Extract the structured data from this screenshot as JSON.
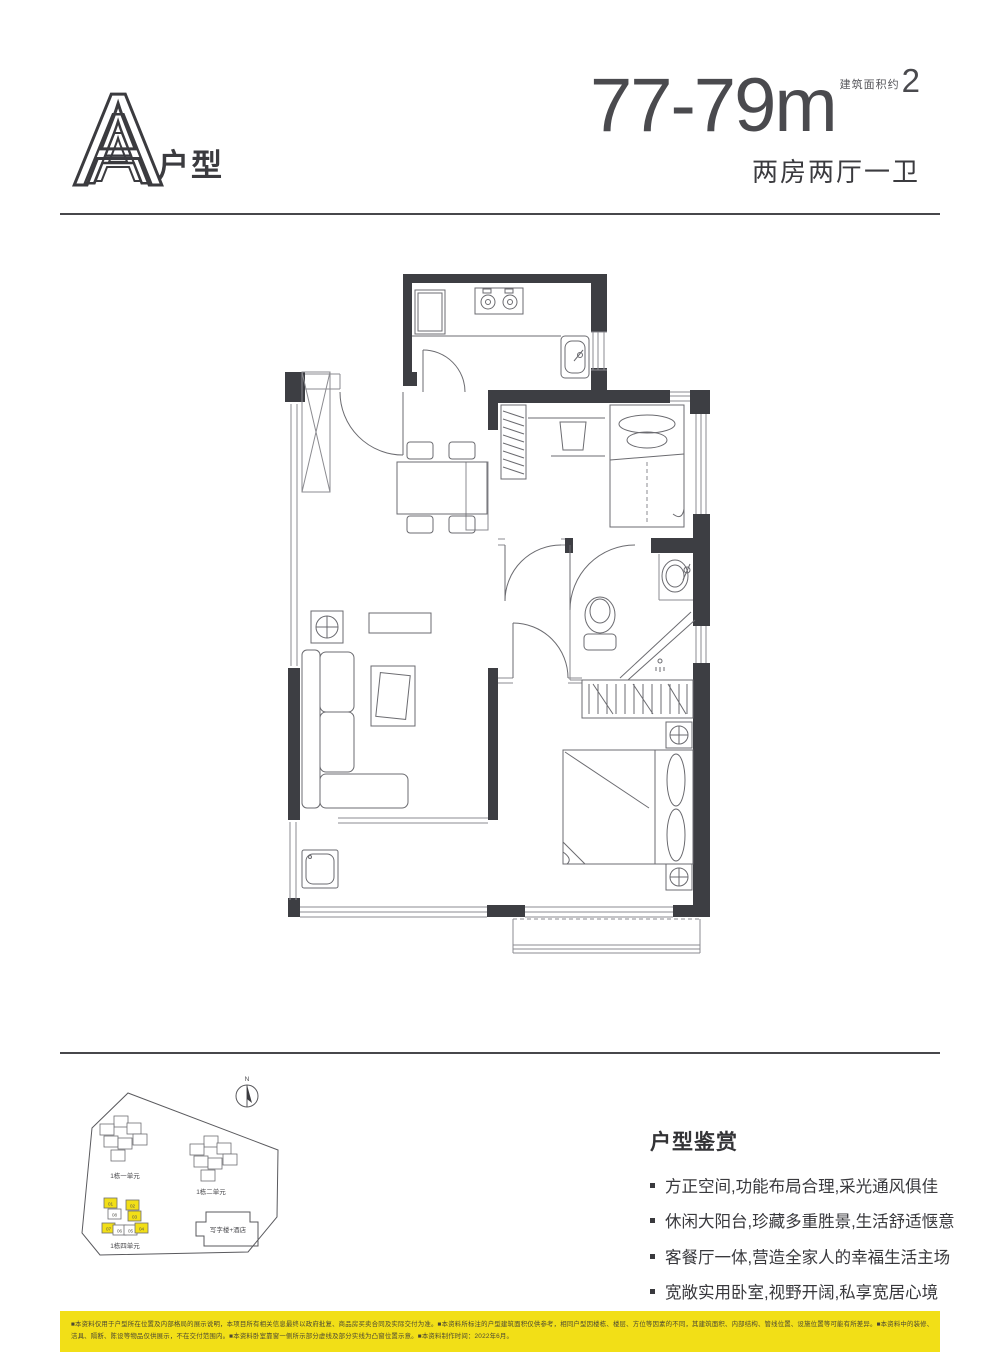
{
  "header": {
    "plan_letter": "A",
    "plan_suffix": "户型",
    "area_value": "77-79m",
    "area_sup": "2",
    "area_note": "建筑面积约",
    "layout_desc": "两房两厅一卫"
  },
  "site_plan": {
    "compass_label": "N",
    "clusters": [
      {
        "label": "1栋一单元",
        "units": [
          "01",
          "02",
          "03",
          "04",
          "05",
          "06"
        ]
      },
      {
        "label": "1栋二单元",
        "units": [
          "01",
          "02",
          "03",
          "04",
          "05",
          "06"
        ]
      },
      {
        "label": "1栋四单元",
        "units": [
          {
            "n": "01",
            "hl": true
          },
          {
            "n": "08",
            "hl": false
          },
          {
            "n": "02",
            "hl": true
          },
          {
            "n": "03",
            "hl": true
          },
          {
            "n": "07",
            "hl": true
          },
          {
            "n": "06",
            "hl": false
          },
          {
            "n": "05",
            "hl": false
          },
          {
            "n": "04",
            "hl": true
          }
        ]
      }
    ],
    "office_label": "写字楼+酒店",
    "highlight_color": "#F2DF17"
  },
  "appreciation": {
    "title": "户型鉴赏",
    "bullets": [
      "方正空间,功能布局合理,采光通风俱佳",
      "休闲大阳台,珍藏多重胜景,生活舒适惬意",
      "客餐厅一体,营造全家人的幸福生活主场",
      "宽敞实用卧室,视野开阔,私享宽居心境"
    ]
  },
  "disclaimer": {
    "bg_color": "#F2DF17",
    "line1": "■本资料仅用于户型所在位置及内部格局的展示说明，本项目所有相关信息最终以政府批复、商品房买卖合同及实际交付为准。■本资料所标注的户型建筑面积仅供参考，相同户型因楼栋、楼层、方位等因素的不同，其建筑面积、内部结构、管线位置、设施位置等可能有所差异。■本资料中的装修、家具、灯具、",
    "line2": "洁具、隔断、陈设等物品仅供展示，不在交付范围内。■本资料卧室靠窗一侧所示部分虚线及部分实线为凸窗位置示意。■本资料制作时间：2022年6月。"
  }
}
